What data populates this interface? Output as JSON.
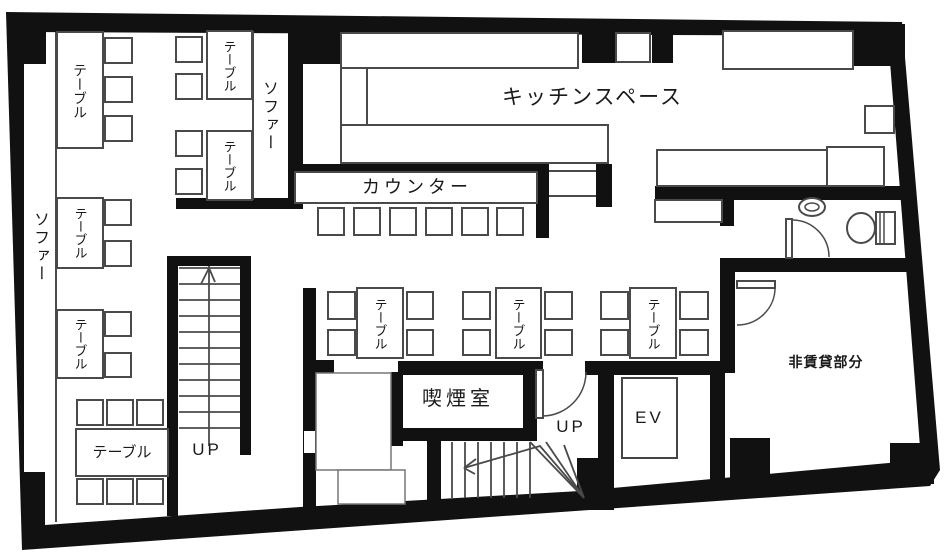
{
  "plan_type": "restaurant-floor-plan",
  "colors": {
    "wall": "#111111",
    "furniture_line": "#4a4a4a",
    "background": "#ffffff",
    "text": "#1a1a1a"
  },
  "rooms": {
    "kitchen": "キッチンスペース",
    "counter": "カウンター",
    "smoking_room": "喫煙室",
    "non_rental": "非賃貸部分",
    "elevator": "EV",
    "stairs_up": "UP"
  },
  "furniture": {
    "table": "テーブル",
    "sofa": "ソファー",
    "table_label_count": 9,
    "sofa_label_count": 2,
    "counter_seat_count": 6,
    "stairs_count": 2
  }
}
